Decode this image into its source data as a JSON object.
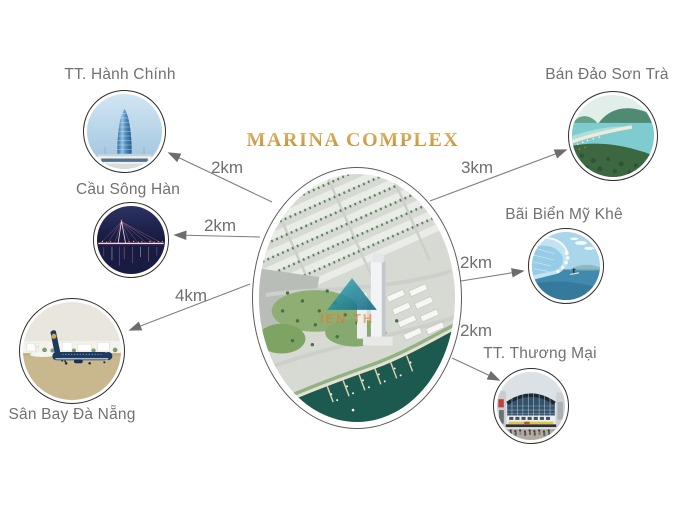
{
  "title": "MARINA COMPLEX",
  "center_watermark": "IEN TH",
  "locations": [
    {
      "id": "hanh-chinh",
      "label": "TT. Hành Chính",
      "distance": "2km",
      "photo": "danang-administrative-center-tower"
    },
    {
      "id": "song-han",
      "label": "Cầu Sông Hàn",
      "distance": "2km",
      "photo": "han-river-bridge-at-night"
    },
    {
      "id": "san-bay",
      "label": "Sân Bay Đà Nẵng",
      "distance": "4km",
      "photo": "danang-airport-airplane"
    },
    {
      "id": "son-tra",
      "label": "Bán Đảo Sơn Trà",
      "distance": "3km",
      "photo": "son-tra-peninsula-bay"
    },
    {
      "id": "my-khe",
      "label": "Bãi Biển Mỹ Khê",
      "distance": "2km",
      "photo": "my-khe-beach-surf-wave"
    },
    {
      "id": "thuong-mai",
      "label": "TT. Thương Mại",
      "distance": "2km",
      "photo": "shopping-mall-building"
    }
  ],
  "colors": {
    "title_gold": "#cf9e4c",
    "label_gray": "#717171",
    "arrow_gray": "#7a7a7a",
    "background": "#ffffff"
  }
}
